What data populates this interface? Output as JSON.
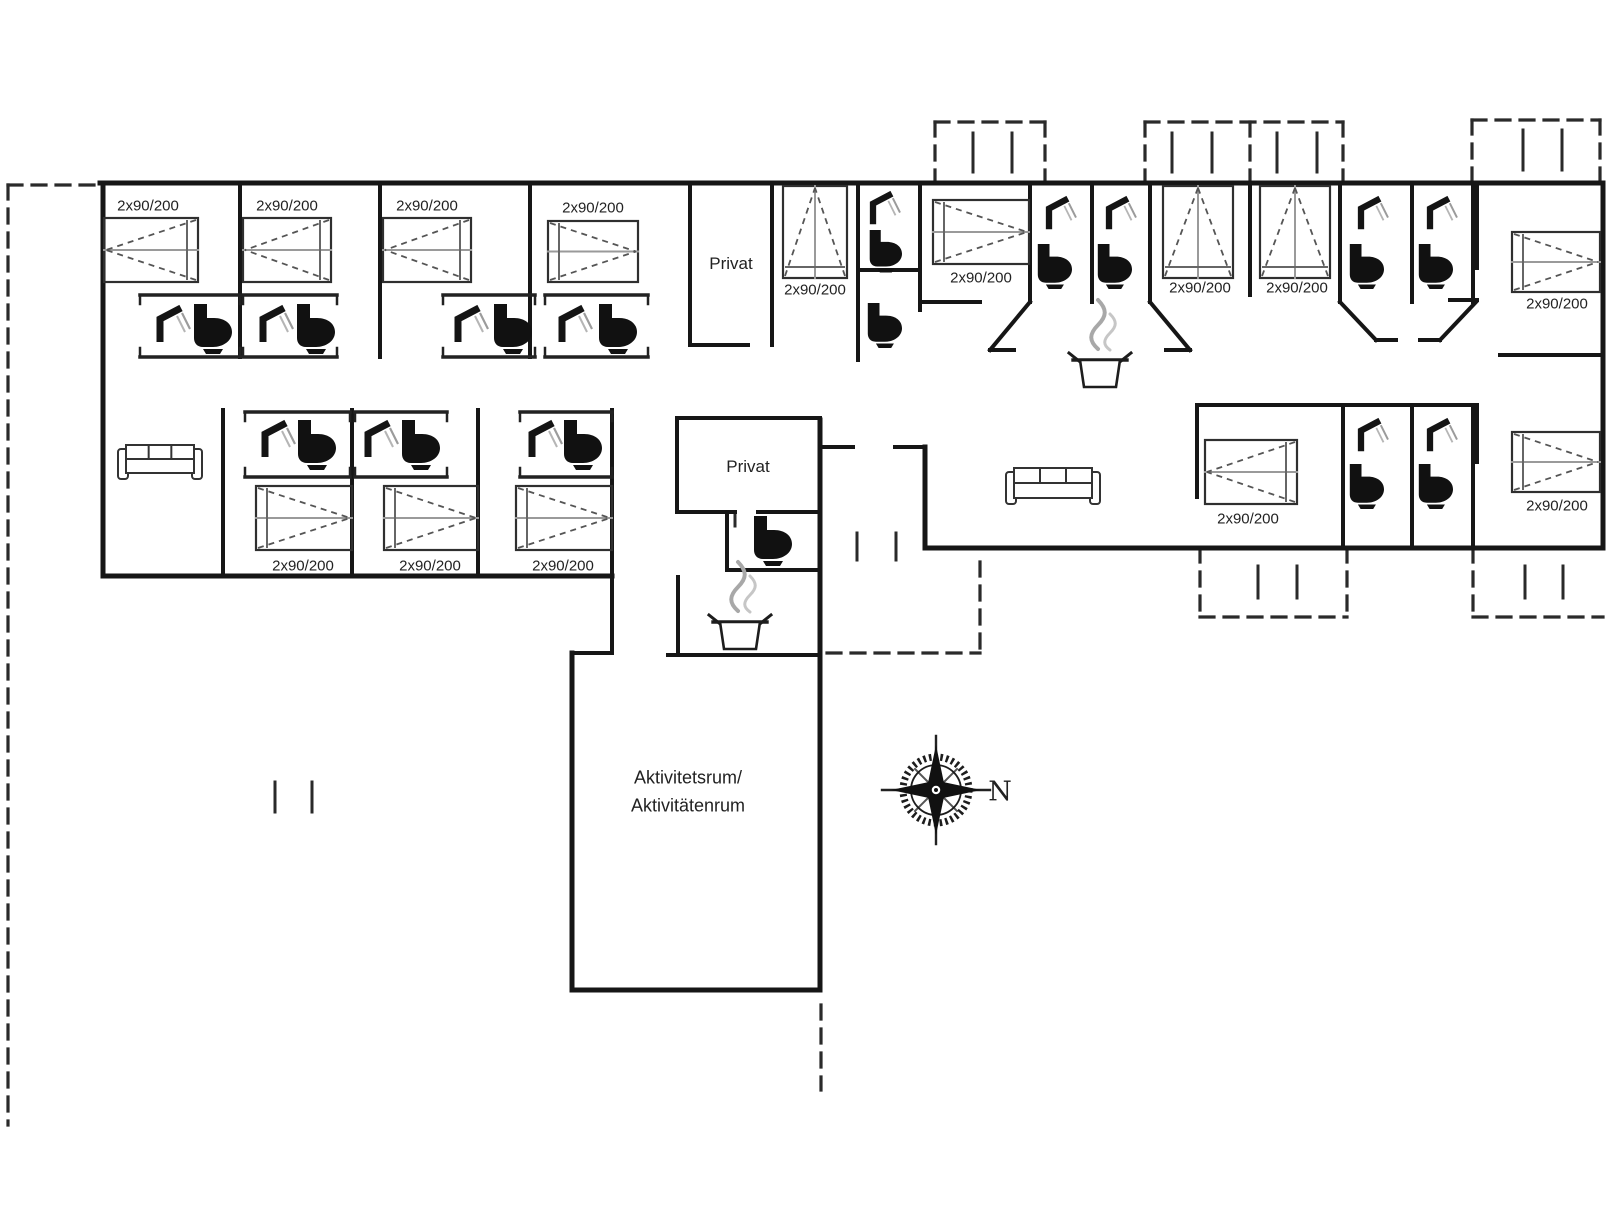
{
  "meta": {
    "type": "floor-plan",
    "ink": "#161616",
    "gray": "#9a9a9a",
    "bed_label": "2x90/200",
    "compass_label": "N"
  },
  "plan": {
    "labels": [
      {
        "id": "bed-size-1",
        "text": "2x90/200",
        "x": 148,
        "y": 205,
        "fs": 15
      },
      {
        "id": "bed-size-2",
        "text": "2x90/200",
        "x": 287,
        "y": 205,
        "fs": 15
      },
      {
        "id": "bed-size-3",
        "text": "2x90/200",
        "x": 427,
        "y": 205,
        "fs": 15
      },
      {
        "id": "bed-size-4",
        "text": "2x90/200",
        "x": 593,
        "y": 207,
        "fs": 15
      },
      {
        "id": "bed-size-5",
        "text": "2x90/200",
        "x": 815,
        "y": 289,
        "fs": 15
      },
      {
        "id": "bed-size-6",
        "text": "2x90/200",
        "x": 981,
        "y": 277,
        "fs": 15
      },
      {
        "id": "bed-size-7",
        "text": "2x90/200",
        "x": 1200,
        "y": 287,
        "fs": 15
      },
      {
        "id": "bed-size-8",
        "text": "2x90/200",
        "x": 1297,
        "y": 287,
        "fs": 15
      },
      {
        "id": "bed-size-9",
        "text": "2x90/200",
        "x": 1557,
        "y": 303,
        "fs": 15
      },
      {
        "id": "bed-size-10",
        "text": "2x90/200",
        "x": 303,
        "y": 565,
        "fs": 15
      },
      {
        "id": "bed-size-11",
        "text": "2x90/200",
        "x": 430,
        "y": 565,
        "fs": 15
      },
      {
        "id": "bed-size-12",
        "text": "2x90/200",
        "x": 563,
        "y": 565,
        "fs": 15
      },
      {
        "id": "bed-size-13",
        "text": "2x90/200",
        "x": 1248,
        "y": 518,
        "fs": 15
      },
      {
        "id": "bed-size-14",
        "text": "2x90/200",
        "x": 1557,
        "y": 505,
        "fs": 15
      },
      {
        "id": "room-privat-1",
        "text": "Privat",
        "x": 731,
        "y": 263,
        "fs": 17
      },
      {
        "id": "room-privat-2",
        "text": "Privat",
        "x": 748,
        "y": 466,
        "fs": 17
      },
      {
        "id": "activity-room-line1",
        "text": "Aktivitetsrum/",
        "x": 688,
        "y": 777,
        "fs": 18
      },
      {
        "id": "activity-room-line2",
        "text": "Aktivitätenrum",
        "x": 688,
        "y": 805,
        "fs": 18
      },
      {
        "id": "compass-n",
        "text": "N",
        "x": 1000,
        "y": 791,
        "fs": 27,
        "serif": true
      }
    ],
    "walls": [
      [
        100,
        183,
        1603,
        183,
        5
      ],
      [
        103,
        183,
        103,
        576,
        5
      ],
      [
        103,
        576,
        612,
        576,
        5
      ],
      [
        612,
        410,
        612,
        653,
        4
      ],
      [
        572,
        653,
        612,
        653,
        4
      ],
      [
        572,
        653,
        572,
        990,
        5
      ],
      [
        572,
        990,
        820,
        990,
        5
      ],
      [
        820,
        420,
        820,
        990,
        5
      ],
      [
        820,
        447,
        853,
        447,
        4
      ],
      [
        895,
        447,
        925,
        447,
        4
      ],
      [
        925,
        447,
        925,
        548,
        5
      ],
      [
        925,
        548,
        1603,
        548,
        5
      ],
      [
        1603,
        183,
        1603,
        548,
        5
      ],
      [
        240,
        183,
        240,
        357,
        4
      ],
      [
        380,
        183,
        380,
        357,
        4
      ],
      [
        530,
        183,
        530,
        357,
        4
      ],
      [
        690,
        183,
        690,
        345,
        4
      ],
      [
        690,
        345,
        748,
        345,
        4
      ],
      [
        772,
        183,
        772,
        345,
        4
      ],
      [
        858,
        183,
        858,
        360,
        4
      ],
      [
        858,
        270,
        920,
        270,
        4
      ],
      [
        920,
        183,
        920,
        310,
        4
      ],
      [
        920,
        302,
        980,
        302,
        4
      ],
      [
        1030,
        183,
        1030,
        302,
        4
      ],
      [
        1092,
        183,
        1092,
        302,
        4
      ],
      [
        1150,
        183,
        1150,
        302,
        4
      ],
      [
        1030,
        302,
        990,
        350,
        4
      ],
      [
        1150,
        302,
        1190,
        350,
        4
      ],
      [
        990,
        350,
        1014,
        350,
        4
      ],
      [
        1190,
        350,
        1166,
        350,
        4
      ],
      [
        1250,
        183,
        1250,
        295,
        4
      ],
      [
        1340,
        183,
        1340,
        302,
        4
      ],
      [
        1412,
        183,
        1412,
        302,
        4
      ],
      [
        1473,
        183,
        1473,
        302,
        4
      ],
      [
        1340,
        302,
        1376,
        340,
        4
      ],
      [
        1476,
        302,
        1440,
        340,
        4
      ],
      [
        1376,
        340,
        1396,
        340,
        4
      ],
      [
        1440,
        340,
        1420,
        340,
        4
      ],
      [
        1477,
        183,
        1477,
        268,
        4
      ],
      [
        1450,
        300,
        1477,
        300,
        4
      ],
      [
        1500,
        355,
        1603,
        355,
        4
      ],
      [
        223,
        410,
        223,
        576,
        4
      ],
      [
        352,
        410,
        352,
        576,
        4
      ],
      [
        478,
        410,
        478,
        576,
        4
      ],
      [
        677,
        418,
        820,
        418,
        4
      ],
      [
        677,
        418,
        677,
        512,
        4
      ],
      [
        677,
        512,
        735,
        512,
        4
      ],
      [
        758,
        512,
        820,
        512,
        4
      ],
      [
        727,
        512,
        727,
        570,
        4
      ],
      [
        727,
        570,
        820,
        570,
        4
      ],
      [
        678,
        577,
        678,
        655,
        4
      ],
      [
        668,
        655,
        820,
        655,
        4
      ],
      [
        1197,
        405,
        1477,
        405,
        4
      ],
      [
        1197,
        405,
        1197,
        497,
        4
      ],
      [
        1343,
        405,
        1343,
        548,
        4
      ],
      [
        1412,
        405,
        1412,
        548,
        4
      ],
      [
        1473,
        405,
        1473,
        548,
        4
      ],
      [
        1477,
        405,
        1477,
        462,
        4
      ]
    ],
    "tracks": [
      {
        "x1": 140,
        "x2": 240,
        "yt": 295,
        "yb": 357
      },
      {
        "x1": 243,
        "x2": 337,
        "yt": 295,
        "yb": 357
      },
      {
        "x1": 443,
        "x2": 535,
        "yt": 295,
        "yb": 357
      },
      {
        "x1": 545,
        "x2": 648,
        "yt": 295,
        "yb": 357
      },
      {
        "x1": 245,
        "x2": 350,
        "yt": 412,
        "yb": 477
      },
      {
        "x1": 355,
        "x2": 447,
        "yt": 412,
        "yb": 477
      },
      {
        "x1": 520,
        "x2": 612,
        "yt": 412,
        "yb": 477
      }
    ],
    "dashed": [
      [
        8,
        185,
        8,
        1125
      ],
      [
        8,
        185,
        100,
        185
      ],
      [
        935,
        122,
        1045,
        122
      ],
      [
        935,
        122,
        935,
        183
      ],
      [
        1045,
        122,
        1045,
        183
      ],
      [
        1145,
        122,
        1343,
        122
      ],
      [
        1145,
        122,
        1145,
        183
      ],
      [
        1343,
        122,
        1343,
        183
      ],
      [
        1250,
        122,
        1250,
        183
      ],
      [
        1472,
        120,
        1600,
        120
      ],
      [
        1472,
        120,
        1472,
        183
      ],
      [
        1600,
        120,
        1600,
        183
      ],
      [
        1200,
        548,
        1200,
        617
      ],
      [
        1200,
        617,
        1347,
        617
      ],
      [
        1347,
        548,
        1347,
        617
      ],
      [
        1473,
        548,
        1473,
        617
      ],
      [
        1473,
        617,
        1603,
        617
      ],
      [
        827,
        653,
        980,
        653
      ],
      [
        980,
        562,
        980,
        653
      ],
      [
        821,
        1005,
        821,
        1090
      ]
    ],
    "ticks": [
      [
        973,
        133,
        973,
        172
      ],
      [
        1012,
        133,
        1012,
        172
      ],
      [
        1172,
        133,
        1172,
        172
      ],
      [
        1212,
        133,
        1212,
        172
      ],
      [
        1277,
        133,
        1277,
        172
      ],
      [
        1317,
        133,
        1317,
        172
      ],
      [
        1523,
        130,
        1523,
        170
      ],
      [
        1562,
        130,
        1562,
        170
      ],
      [
        1258,
        566,
        1258,
        598
      ],
      [
        1297,
        566,
        1297,
        598
      ],
      [
        1525,
        566,
        1525,
        598
      ],
      [
        1563,
        566,
        1563,
        598
      ],
      [
        857,
        533,
        857,
        560
      ],
      [
        896,
        533,
        896,
        560
      ],
      [
        275,
        782,
        275,
        812
      ],
      [
        312,
        782,
        312,
        812
      ],
      [
        735,
        512,
        735,
        526
      ]
    ],
    "beds": [
      {
        "x": 104,
        "y": 218,
        "w": 94,
        "h": 64,
        "dir": "left"
      },
      {
        "x": 243,
        "y": 218,
        "w": 88,
        "h": 64,
        "dir": "left"
      },
      {
        "x": 383,
        "y": 218,
        "w": 88,
        "h": 64,
        "dir": "left"
      },
      {
        "x": 548,
        "y": 221,
        "w": 90,
        "h": 61,
        "dir": "right"
      },
      {
        "x": 783,
        "y": 186,
        "w": 64,
        "h": 92,
        "dir": "up"
      },
      {
        "x": 933,
        "y": 200,
        "w": 96,
        "h": 64,
        "dir": "right"
      },
      {
        "x": 1163,
        "y": 186,
        "w": 70,
        "h": 92,
        "dir": "up"
      },
      {
        "x": 1260,
        "y": 186,
        "w": 70,
        "h": 92,
        "dir": "up"
      },
      {
        "x": 1512,
        "y": 232,
        "w": 88,
        "h": 60,
        "dir": "right"
      },
      {
        "x": 256,
        "y": 486,
        "w": 96,
        "h": 64,
        "dir": "right"
      },
      {
        "x": 384,
        "y": 486,
        "w": 94,
        "h": 64,
        "dir": "right"
      },
      {
        "x": 516,
        "y": 486,
        "w": 96,
        "h": 64,
        "dir": "right"
      },
      {
        "x": 1205,
        "y": 440,
        "w": 92,
        "h": 64,
        "dir": "left"
      },
      {
        "x": 1512,
        "y": 432,
        "w": 88,
        "h": 60,
        "dir": "right"
      }
    ],
    "toilets": [
      {
        "x": 192,
        "y": 304
      },
      {
        "x": 295,
        "y": 304
      },
      {
        "x": 492,
        "y": 304
      },
      {
        "x": 597,
        "y": 304
      },
      {
        "x": 868,
        "y": 230,
        "s": 0.85
      },
      {
        "x": 866,
        "y": 303,
        "s": 0.9
      },
      {
        "x": 1036,
        "y": 244,
        "s": 0.9
      },
      {
        "x": 1096,
        "y": 244,
        "s": 0.9
      },
      {
        "x": 1348,
        "y": 244,
        "s": 0.9
      },
      {
        "x": 1417,
        "y": 244,
        "s": 0.9
      },
      {
        "x": 1348,
        "y": 464,
        "s": 0.9
      },
      {
        "x": 1417,
        "y": 464,
        "s": 0.9
      },
      {
        "x": 296,
        "y": 420
      },
      {
        "x": 400,
        "y": 420
      },
      {
        "x": 562,
        "y": 420
      },
      {
        "x": 752,
        "y": 516
      }
    ],
    "showers": [
      {
        "x": 150,
        "y": 305
      },
      {
        "x": 253,
        "y": 305
      },
      {
        "x": 448,
        "y": 305
      },
      {
        "x": 552,
        "y": 305
      },
      {
        "x": 864,
        "y": 191,
        "s": 0.9
      },
      {
        "x": 1040,
        "y": 196,
        "s": 0.9
      },
      {
        "x": 1100,
        "y": 196,
        "s": 0.9
      },
      {
        "x": 1352,
        "y": 196,
        "s": 0.9
      },
      {
        "x": 1421,
        "y": 196,
        "s": 0.9
      },
      {
        "x": 1352,
        "y": 418,
        "s": 0.9
      },
      {
        "x": 1421,
        "y": 418,
        "s": 0.9
      },
      {
        "x": 255,
        "y": 420
      },
      {
        "x": 358,
        "y": 420
      },
      {
        "x": 522,
        "y": 420
      }
    ],
    "sofas": [
      {
        "x": 118,
        "y": 443,
        "w": 84,
        "h": 38
      },
      {
        "x": 1006,
        "y": 466,
        "w": 94,
        "h": 40
      }
    ],
    "pots": [
      {
        "cx": 1100,
        "top": 350
      },
      {
        "cx": 740,
        "top": 612
      }
    ],
    "compass": {
      "cx": 936,
      "cy": 790
    }
  }
}
